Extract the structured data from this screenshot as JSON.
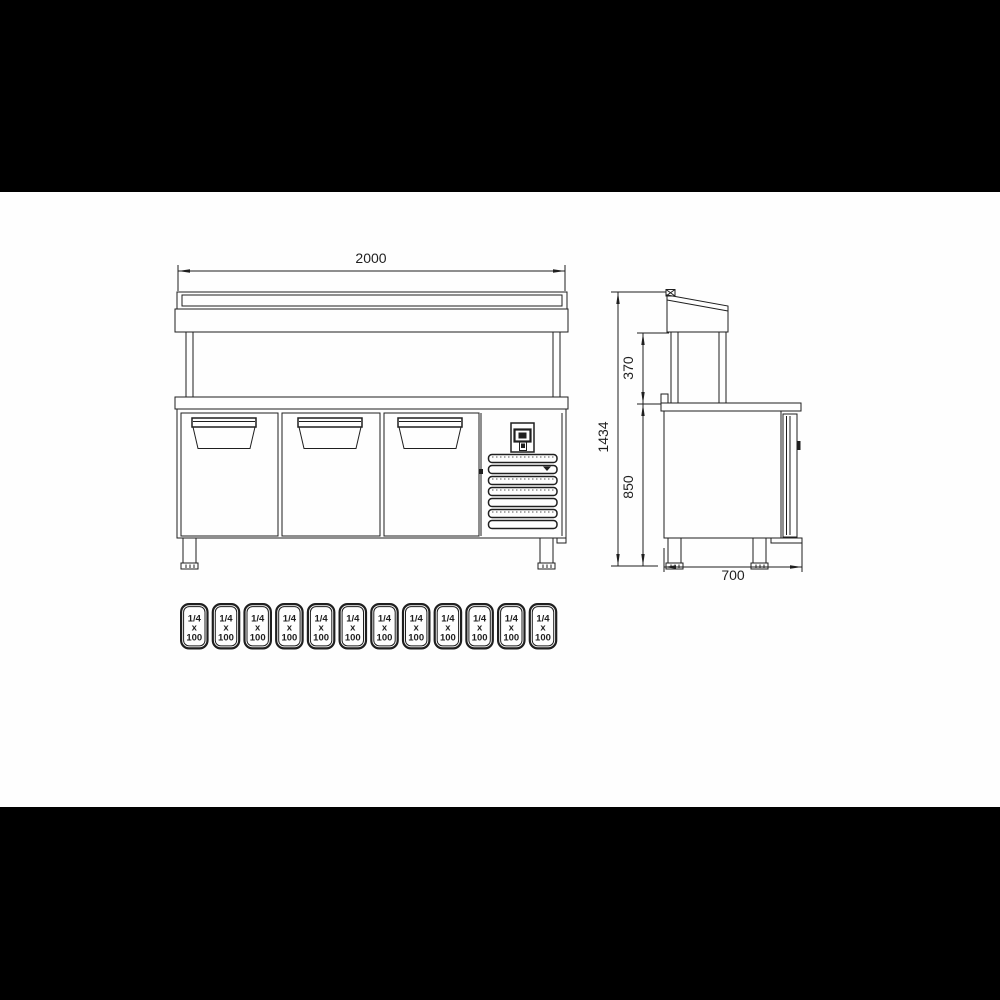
{
  "front_view": {
    "width_label": "2000"
  },
  "side_view": {
    "height_total_label": "1434",
    "canopy_height_label": "370",
    "body_height_label": "850",
    "depth_label": "700"
  },
  "pans": {
    "items": [
      {
        "top": "1/4",
        "mid": "x",
        "bottom": "100"
      },
      {
        "top": "1/4",
        "mid": "x",
        "bottom": "100"
      },
      {
        "top": "1/4",
        "mid": "x",
        "bottom": "100"
      },
      {
        "top": "1/4",
        "mid": "x",
        "bottom": "100"
      },
      {
        "top": "1/4",
        "mid": "x",
        "bottom": "100"
      },
      {
        "top": "1/4",
        "mid": "x",
        "bottom": "100"
      },
      {
        "top": "1/4",
        "mid": "x",
        "bottom": "100"
      },
      {
        "top": "1/4",
        "mid": "x",
        "bottom": "100"
      },
      {
        "top": "1/4",
        "mid": "x",
        "bottom": "100"
      },
      {
        "top": "1/4",
        "mid": "x",
        "bottom": "100"
      },
      {
        "top": "1/4",
        "mid": "x",
        "bottom": "100"
      },
      {
        "top": "1/4",
        "mid": "x",
        "bottom": "100"
      }
    ]
  },
  "colors": {
    "page_background": "#000000",
    "paper": "#fefefe",
    "line": "#1f1f1f"
  }
}
